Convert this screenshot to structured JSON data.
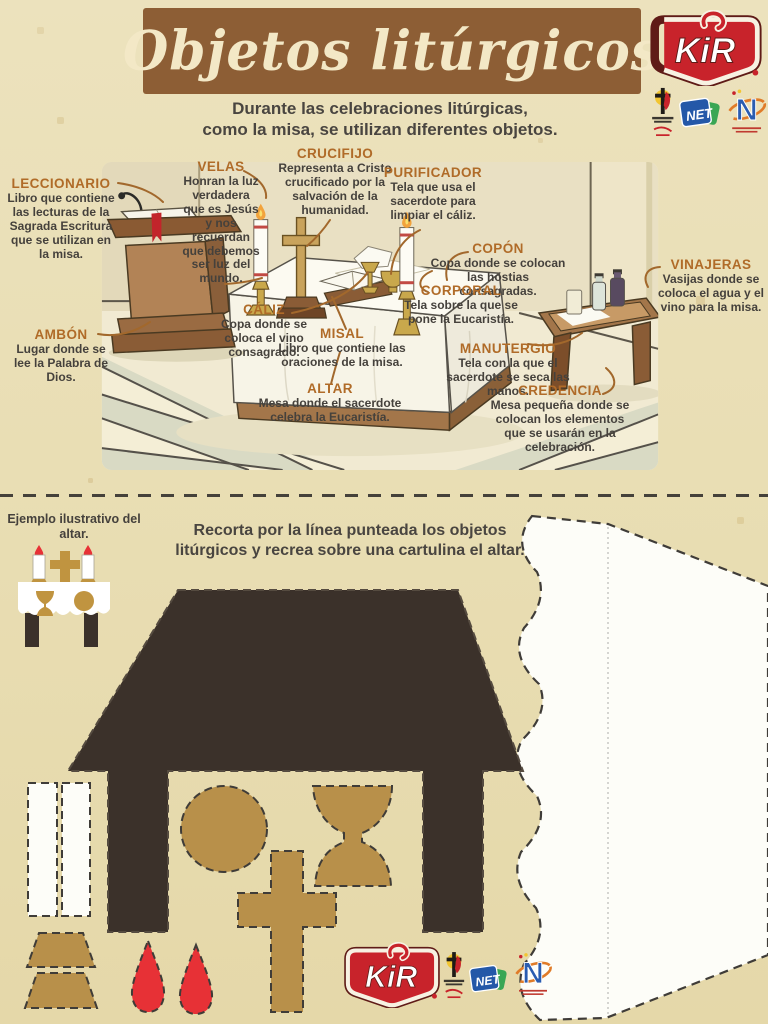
{
  "header": {
    "title": "Objetos litúrgicos",
    "subtitle": "Durante las celebraciones litúrgicas,\ncomo la misa, se utilizan diferentes objetos."
  },
  "brand": {
    "kir": "KiR",
    "net": "NET",
    "n_program": "N"
  },
  "labels": [
    {
      "id": "leccionario",
      "name": "LECCIONARIO",
      "desc": "Libro que contiene las lecturas de la Sagrada Escritura que se utilizan en la misa."
    },
    {
      "id": "ambon",
      "name": "AMBÓN",
      "desc": "Lugar donde se lee la Palabra de Dios."
    },
    {
      "id": "velas",
      "name": "VELAS",
      "desc": "Honran la luz verdadera que es Jesús y nos recuerdan que debemos ser luz del mundo."
    },
    {
      "id": "crucifijo",
      "name": "CRUCIFIJO",
      "desc": "Representa a Cristo crucificado por la salvación de la humanidad."
    },
    {
      "id": "purificador",
      "name": "PURIFICADOR",
      "desc": "Tela que usa el sacerdote para limpiar el cáliz."
    },
    {
      "id": "copon",
      "name": "COPÓN",
      "desc": "Copa donde se colocan las hostias consagradas."
    },
    {
      "id": "corporal",
      "name": "CORPORAL",
      "desc": "Tela sobre la que se pone la Eucaristía."
    },
    {
      "id": "vinajeras",
      "name": "VINAJERAS",
      "desc": "Vasijas donde se coloca el agua y el vino para la misa."
    },
    {
      "id": "caliz",
      "name": "CÁLIZ",
      "desc": "Copa donde se coloca el vino consagrado."
    },
    {
      "id": "misal",
      "name": "MISAL",
      "desc": "Libro que contiene las oraciones de la misa."
    },
    {
      "id": "manutergio",
      "name": "MANUTERGIO",
      "desc": "Tela con la que el sacerdote se seca las manos."
    },
    {
      "id": "credencia",
      "name": "CREDENCIA",
      "desc": "Mesa pequeña donde se colocan los elementos que se usarán en la celebración."
    },
    {
      "id": "altar",
      "name": "ALTAR",
      "desc": "Mesa donde el sacerdote celebra la Eucaristía."
    }
  ],
  "activity": {
    "example_caption": "Ejemplo ilustrativo del altar.",
    "instruction": "Recorta por la línea punteada los objetos\nlitúrgicos y recrea sobre una cartulina el altar."
  },
  "colors": {
    "paper": "#e9deb4",
    "banner_brown": "#8d5e35",
    "banner_text": "#f3e8c6",
    "label_accent": "#b06b28",
    "body_text": "#45413c",
    "cutout_gold": "#b8904a",
    "cutout_dark": "#3b312a",
    "flame_red": "#e73136",
    "kir_red": "#c8232b",
    "net_blue": "#2458a8",
    "net_green": "#3aa654"
  }
}
